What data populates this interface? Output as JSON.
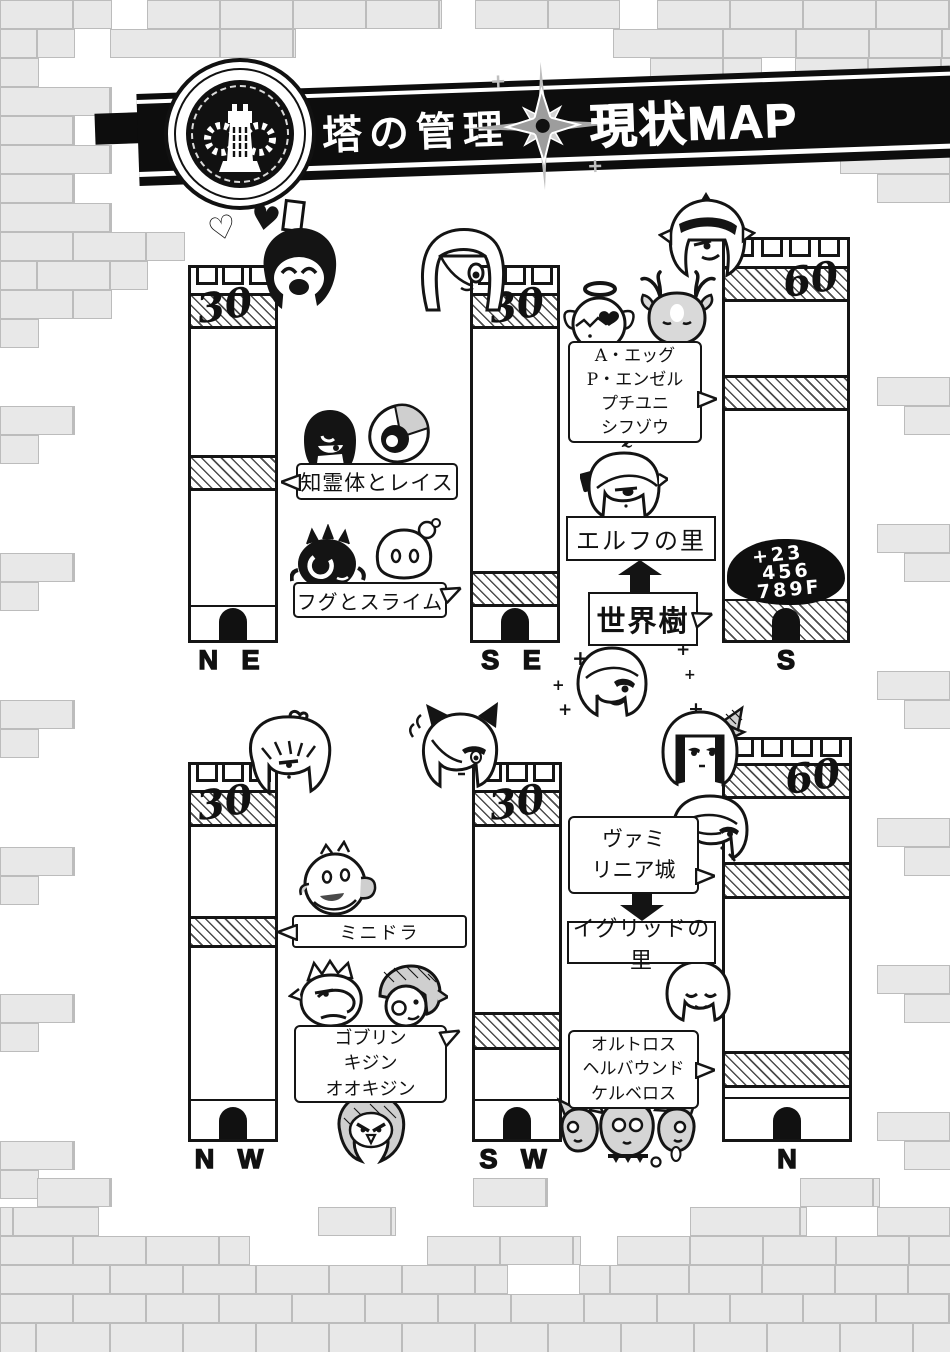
{
  "header": {
    "title_left": "塔の管理",
    "title_right": "現状MAP",
    "emblem_icon": "tower-gear-emblem",
    "divider_icon": "compass-rose"
  },
  "towers": {
    "ne": {
      "level": "30",
      "label": "N E"
    },
    "se": {
      "level": "30",
      "label": "S E"
    },
    "s": {
      "level": "60",
      "label": "S"
    },
    "nw": {
      "level": "30",
      "label": "N W"
    },
    "sw": {
      "level": "30",
      "label": "S W"
    },
    "n": {
      "level": "60",
      "label": "N"
    }
  },
  "callouts": {
    "chireitai": {
      "text": "知霊体とレイス"
    },
    "fugu_slime": {
      "text": "フグとスライム"
    },
    "s_monsters": {
      "line1": "A・エッグ",
      "line2": "P・エンゼル",
      "line3": "プチユニ",
      "line4": "シフゾウ"
    },
    "elf_village": {
      "text": "エルフの里"
    },
    "world_tree": {
      "text": "世界樹"
    },
    "floor_note": {
      "line1": "+23",
      "line2": "456",
      "line3": "789F"
    },
    "vamilinia": {
      "line1": "ヴァミ",
      "line2": "リニア城"
    },
    "igrid_village": {
      "text": "イグリッドの里"
    },
    "minidora": {
      "text": "ミニドラ"
    },
    "goblins": {
      "line1": "ゴブリン",
      "line2": "キジン",
      "line3": "オオキジン"
    },
    "hellhounds": {
      "line1": "オルトロス",
      "line2": "ヘルバウンド",
      "line3": "ケルベロス"
    }
  },
  "decor": {
    "heart_filled": "♥",
    "heart_outline": "♡",
    "sparkle": "+",
    "sleep_mark": "z"
  },
  "colors": {
    "ink": "#151515",
    "banner": "#0d0d0d",
    "brick_fill": "#e8e8e8",
    "brick_line": "#bcbcbc",
    "gray_tone": "#cfcfcf"
  }
}
